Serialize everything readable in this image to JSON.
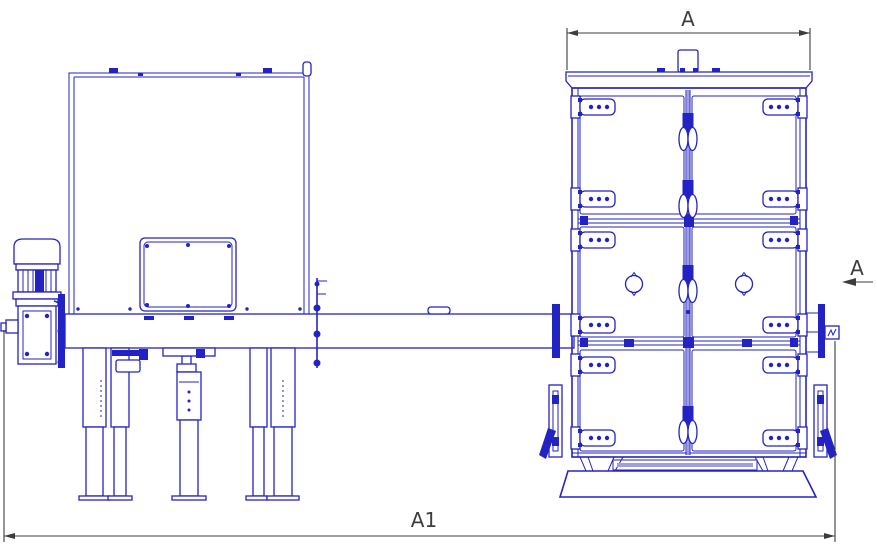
{
  "drawing": {
    "labels": {
      "top_width_dim": "A",
      "section_view": "A",
      "overall_length_dim": "A1"
    },
    "colors": {
      "line": "#2323c3",
      "line_light": "#9f9fe0",
      "dimension": "#3d3d3d",
      "background": "#ffffff"
    }
  }
}
